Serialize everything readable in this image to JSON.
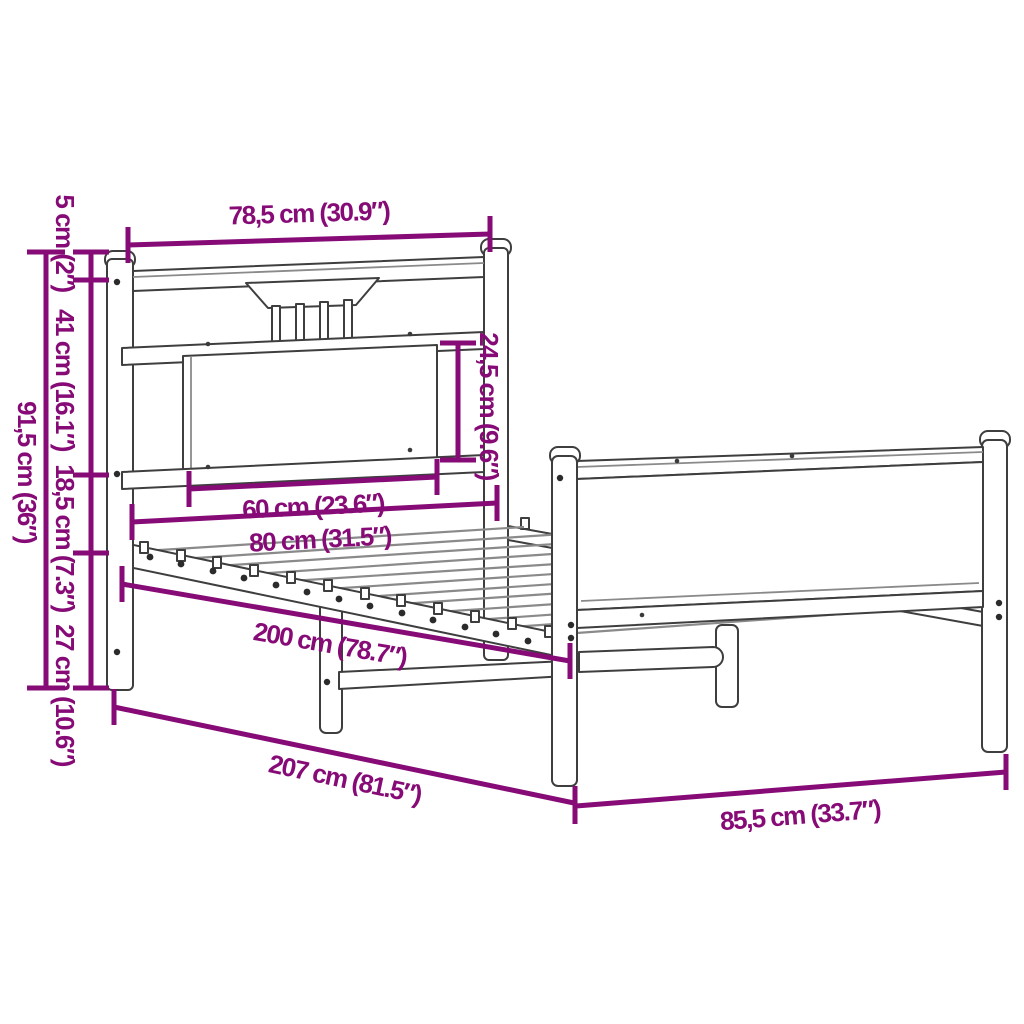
{
  "title": "Bed frame dimension diagram",
  "colors": {
    "dimension": "#860b76",
    "outline": "#3e3e3e",
    "background": "#ffffff"
  },
  "dimensions": {
    "headboard_width": "78,5 cm (30.9″)",
    "post_cap_height": "5 cm (2″)",
    "headboard_upper_height": "41 cm (16.1″)",
    "headboard_mid_height": "18,5 cm (7.3″)",
    "under_frame_clearance": "27 cm (10.6″)",
    "headboard_total_height": "91,5 cm (36″)",
    "panel_height": "24,5 cm (9.6″)",
    "panel_width": "60 cm (23.6″)",
    "bed_width": "80 cm (31.5″)",
    "sleeping_length": "200 cm (78.7″)",
    "total_length": "207 cm (81.5″)",
    "footboard_width": "85,5 cm (33.7″)"
  }
}
